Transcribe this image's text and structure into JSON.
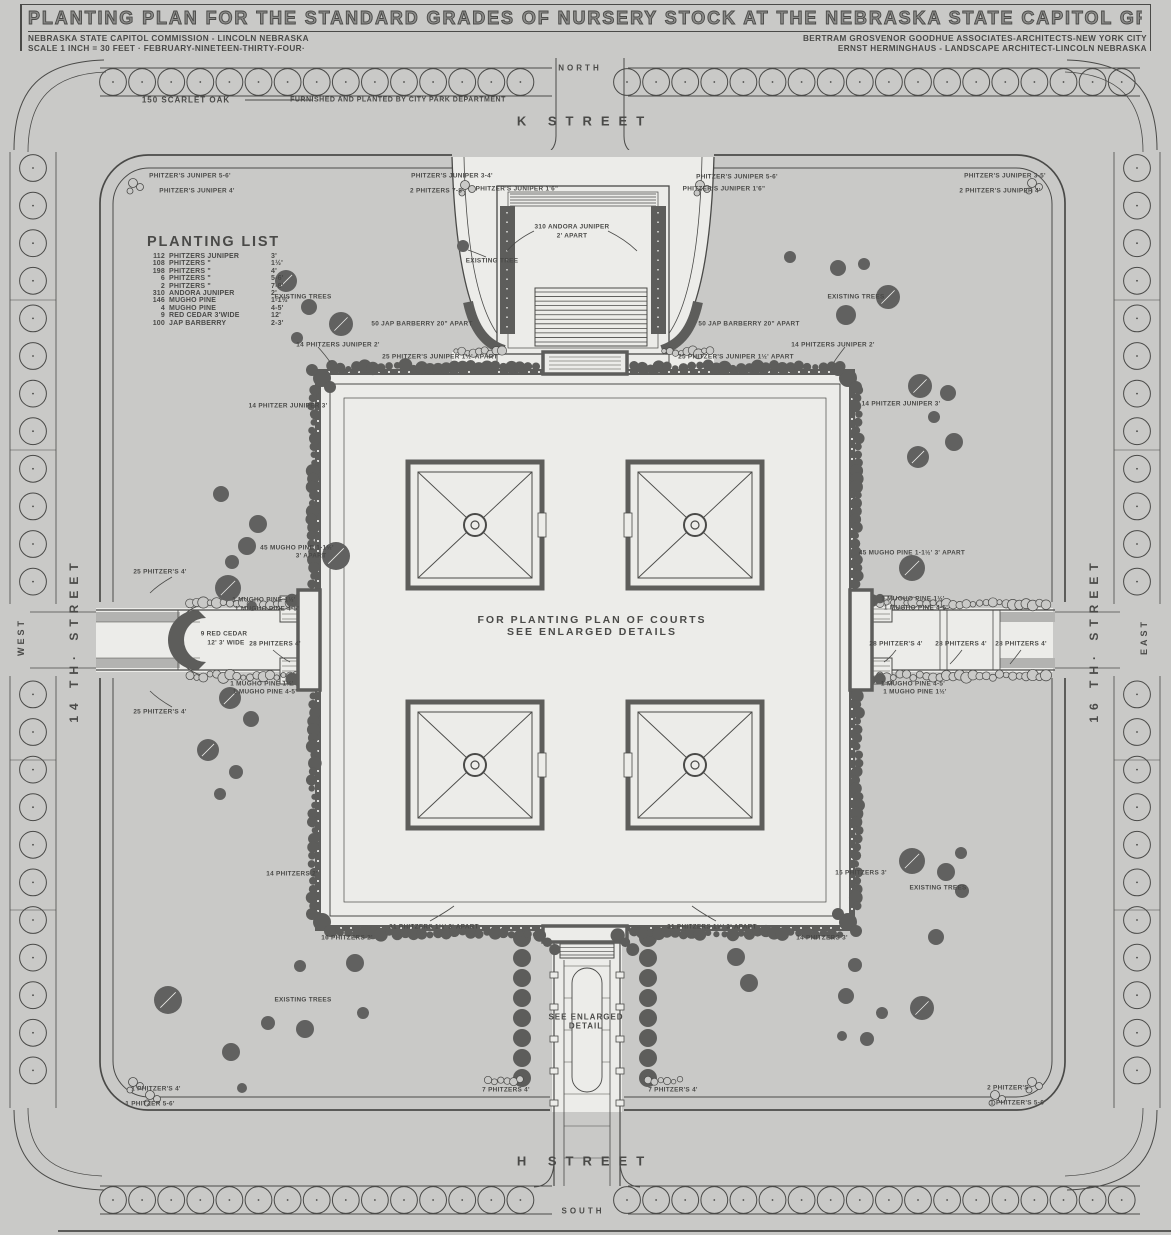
{
  "colors": {
    "paper": "#c9c9c7",
    "ink": "#4a4a48",
    "dark": "#5d5d5b",
    "tree": "#616160",
    "light": "#b3b3b1",
    "white": "#ecece9"
  },
  "header": {
    "title": "PLANTING PLAN FOR THE STANDARD GRADES OF NURSERY STOCK AT THE NEBRASKA STATE CAPITOL GROUNDS",
    "left_line1": "NEBRASKA STATE CAPITOL COMMISSION - LINCOLN NEBRASKA",
    "left_line2": "SCALE 1 INCH = 30 FEET · FEBRUARY-NINETEEN-THIRTY-FOUR·",
    "right_line1": "BERTRAM GROSVENOR GOODHUE ASSOCIATES-ARCHITECTS-NEW YORK CITY",
    "right_line2": "ERNST HERMINGHAUS - LANDSCAPE ARCHITECT-LINCOLN NEBRASKA"
  },
  "planting_list": {
    "title": "PLANTING LIST",
    "rows": [
      [
        "112",
        "PHITZERS JUNIPER",
        "3'"
      ],
      [
        "108",
        "PHITZERS \"",
        "1½'"
      ],
      [
        "198",
        "PHITZERS \"",
        "4'"
      ],
      [
        "6",
        "PHITZERS \"",
        "5-6'"
      ],
      [
        "2",
        "PHITZERS \"",
        "7-8'"
      ],
      [
        "310",
        "ANDORA JUNIPER",
        "2'"
      ],
      [
        "146",
        "MUGHO PINE",
        "1-1½'"
      ],
      [
        "4",
        "MUGHO PINE",
        "4-5'"
      ],
      [
        "9",
        "RED CEDAR 3'WIDE",
        "12'"
      ],
      [
        "100",
        "JAP BARBERRY",
        "2-3'"
      ]
    ]
  },
  "compass": [
    {
      "t": "NORTH",
      "x": 580,
      "y": 68,
      "s": 8,
      "ls": 3
    },
    {
      "t": "SOUTH",
      "x": 583,
      "y": 1211,
      "s": 8,
      "ls": 3
    },
    {
      "t": "WEST",
      "x": 21,
      "y": 637,
      "s": 9,
      "ls": 3,
      "rot": -90
    },
    {
      "t": "EAST",
      "x": 1144,
      "y": 637,
      "s": 9,
      "ls": 3,
      "rot": -90
    }
  ],
  "streets": [
    {
      "t": "K STREET",
      "x": 585,
      "y": 121,
      "s": 13,
      "ls": 9
    },
    {
      "t": "H STREET",
      "x": 585,
      "y": 1161,
      "s": 13,
      "ls": 9
    },
    {
      "t": "14 TH· STREET",
      "x": 74,
      "y": 640,
      "s": 12,
      "ls": 6,
      "rot": -90
    },
    {
      "t": "16 TH· STREET",
      "x": 1094,
      "y": 640,
      "s": 12,
      "ls": 6,
      "rot": -90
    }
  ],
  "notes": [
    {
      "t": "150 SCARLET OAK",
      "x": 186,
      "y": 100,
      "s": 8,
      "ls": 1
    },
    {
      "t": "FURNISHED AND PLANTED BY CITY PARK DEPARTMENT",
      "x": 398,
      "y": 100,
      "s": 7,
      "ls": 0.5
    },
    {
      "t": "FOR PLANTING PLAN OF COURTS",
      "x": 592,
      "y": 620,
      "s": 10.5,
      "ls": 2
    },
    {
      "t": "SEE ENLARGED DETAILS",
      "x": 592,
      "y": 632,
      "s": 10.5,
      "ls": 2
    },
    {
      "t": "SEE ENLARGED",
      "x": 586,
      "y": 1017,
      "s": 8,
      "ls": 1
    },
    {
      "t": "DETAIL",
      "x": 586,
      "y": 1026,
      "s": 8,
      "ls": 1
    }
  ],
  "annotations": [
    {
      "t": "PHITZER'S JUNIPER 5-6'",
      "x": 190,
      "y": 176
    },
    {
      "t": "PHITZER'S JUNIPER 4'",
      "x": 197,
      "y": 191
    },
    {
      "t": "PHITZER'S JUNIPER 3-4'",
      "x": 452,
      "y": 176
    },
    {
      "t": "2 PHITZERS 7-8'",
      "x": 437,
      "y": 191
    },
    {
      "t": "PHITZER'S JUNIPER 1'6\"",
      "x": 517,
      "y": 189
    },
    {
      "t": "PHITZER'S JUNIPER 1'6\"",
      "x": 724,
      "y": 189
    },
    {
      "t": "PHITZER'S JUNIPER 5-6'",
      "x": 737,
      "y": 177
    },
    {
      "t": "PHITZER'S JUNIPER 3-5'",
      "x": 1005,
      "y": 176
    },
    {
      "t": "2 PHITZER'S JUNIPER 4'",
      "x": 1000,
      "y": 191
    },
    {
      "t": "310 ANDORA JUNIPER",
      "x": 572,
      "y": 227
    },
    {
      "t": "2' APART",
      "x": 572,
      "y": 236
    },
    {
      "t": "EXISTING TREE",
      "x": 492,
      "y": 261
    },
    {
      "t": "EXISTING TREES",
      "x": 303,
      "y": 297
    },
    {
      "t": "EXISTING TREES",
      "x": 856,
      "y": 297
    },
    {
      "t": "50 JAP BARBERRY 20\" APART",
      "x": 422,
      "y": 324
    },
    {
      "t": "50 JAP BARBERRY 20\" APART",
      "x": 749,
      "y": 324
    },
    {
      "t": "14 PHITZERS JUNIPER 2'",
      "x": 338,
      "y": 345
    },
    {
      "t": "14 PHITZERS JUNIPER 2'",
      "x": 833,
      "y": 345
    },
    {
      "t": "25 PHITZER'S JUNIPER 1½' APART",
      "x": 440,
      "y": 357
    },
    {
      "t": "25 PHITZER'S JUNIPER 1½' APART",
      "x": 736,
      "y": 357
    },
    {
      "t": "14 PHITZER JUNIPER 3'",
      "x": 288,
      "y": 406
    },
    {
      "t": "14 PHITZER JUNIPER 3'",
      "x": 901,
      "y": 404
    },
    {
      "t": "45 MUGHO PINE 1-1½'",
      "x": 297,
      "y": 548
    },
    {
      "t": "3' APART",
      "x": 311,
      "y": 556
    },
    {
      "t": "45 MUGHO PINE 1-1½'  3' APART",
      "x": 912,
      "y": 553
    },
    {
      "t": "25 PHITZER'S 4'",
      "x": 160,
      "y": 572
    },
    {
      "t": "1 MUGHO PINE 1½'",
      "x": 264,
      "y": 600
    },
    {
      "t": "1 MUGHO PINE 4-5'",
      "x": 267,
      "y": 609
    },
    {
      "t": "9 RED CEDAR",
      "x": 224,
      "y": 634
    },
    {
      "t": "12'  3' WIDE",
      "x": 226,
      "y": 643
    },
    {
      "t": "28 PHITZERS 4'",
      "x": 275,
      "y": 644
    },
    {
      "t": "1 MUGHO PINE 1½'",
      "x": 262,
      "y": 684
    },
    {
      "t": "1 MUGHO PINE 4-5'",
      "x": 265,
      "y": 692
    },
    {
      "t": "25 PHITZER'S 4'",
      "x": 160,
      "y": 712
    },
    {
      "t": "1 MUGHO PINE 1½'",
      "x": 913,
      "y": 599
    },
    {
      "t": "1 MUGHO PINE 4-5'",
      "x": 916,
      "y": 608
    },
    {
      "t": "28 PHITZER'S 4'",
      "x": 896,
      "y": 644
    },
    {
      "t": "28 PHITZERS 4'",
      "x": 961,
      "y": 644
    },
    {
      "t": "28 PHITZERS 4'",
      "x": 1021,
      "y": 644
    },
    {
      "t": "1 MUGHO PINE 4-5'",
      "x": 913,
      "y": 684
    },
    {
      "t": "1 MUGHO PINE 1½'",
      "x": 915,
      "y": 692
    },
    {
      "t": "14 PHITZERS 2'",
      "x": 292,
      "y": 874
    },
    {
      "t": "16 PHITZERS 3'",
      "x": 861,
      "y": 873
    },
    {
      "t": "EXISTING TREES",
      "x": 938,
      "y": 888
    },
    {
      "t": "EXISTING TREES",
      "x": 303,
      "y": 1000
    },
    {
      "t": "16 PHITZERS 2'",
      "x": 347,
      "y": 938
    },
    {
      "t": "31 PHITZERS 1½' 3' APART",
      "x": 434,
      "y": 927
    },
    {
      "t": "31 PHITZERS 1½' 3' APART",
      "x": 712,
      "y": 927
    },
    {
      "t": "14 PHITZERS 3'",
      "x": 822,
      "y": 938
    },
    {
      "t": "7 PHITZERS 4'",
      "x": 506,
      "y": 1090
    },
    {
      "t": "7 PHITZER'S 4'",
      "x": 673,
      "y": 1090
    },
    {
      "t": "1 PHITZER'S 4'",
      "x": 156,
      "y": 1089
    },
    {
      "t": "1 PHITZER 5-6'",
      "x": 150,
      "y": 1104
    },
    {
      "t": "2 PHITZER'S",
      "x": 1008,
      "y": 1088
    },
    {
      "t": "1 PHITZER'S 5-6'",
      "x": 1018,
      "y": 1103
    }
  ],
  "existing_trees": [
    [
      286,
      281,
      11
    ],
    [
      309,
      307,
      8
    ],
    [
      341,
      324,
      12
    ],
    [
      297,
      338,
      6
    ],
    [
      838,
      268,
      8
    ],
    [
      864,
      264,
      6
    ],
    [
      888,
      297,
      12
    ],
    [
      846,
      315,
      10
    ],
    [
      790,
      257,
      6
    ],
    [
      920,
      386,
      12
    ],
    [
      948,
      393,
      8
    ],
    [
      934,
      417,
      6
    ],
    [
      954,
      442,
      9
    ],
    [
      918,
      457,
      11
    ],
    [
      221,
      494,
      8
    ],
    [
      258,
      524,
      9
    ],
    [
      247,
      546,
      9
    ],
    [
      232,
      562,
      7
    ],
    [
      228,
      588,
      13
    ],
    [
      252,
      606,
      5
    ],
    [
      336,
      556,
      14
    ],
    [
      912,
      568,
      13
    ],
    [
      230,
      698,
      11
    ],
    [
      251,
      719,
      8
    ],
    [
      208,
      750,
      11
    ],
    [
      236,
      772,
      7
    ],
    [
      220,
      794,
      6
    ],
    [
      168,
      1000,
      14
    ],
    [
      231,
      1052,
      9
    ],
    [
      268,
      1023,
      7
    ],
    [
      305,
      1029,
      9
    ],
    [
      355,
      963,
      9
    ],
    [
      300,
      966,
      6
    ],
    [
      363,
      1013,
      6
    ],
    [
      242,
      1088,
      5
    ],
    [
      912,
      861,
      13
    ],
    [
      946,
      872,
      9
    ],
    [
      962,
      891,
      7
    ],
    [
      936,
      937,
      8
    ],
    [
      961,
      853,
      6
    ],
    [
      855,
      965,
      7
    ],
    [
      846,
      996,
      8
    ],
    [
      882,
      1013,
      6
    ],
    [
      922,
      1008,
      12
    ],
    [
      842,
      1036,
      5
    ],
    [
      867,
      1039,
      7
    ],
    [
      736,
      957,
      9
    ],
    [
      749,
      983,
      9
    ],
    [
      463,
      246,
      6
    ]
  ]
}
